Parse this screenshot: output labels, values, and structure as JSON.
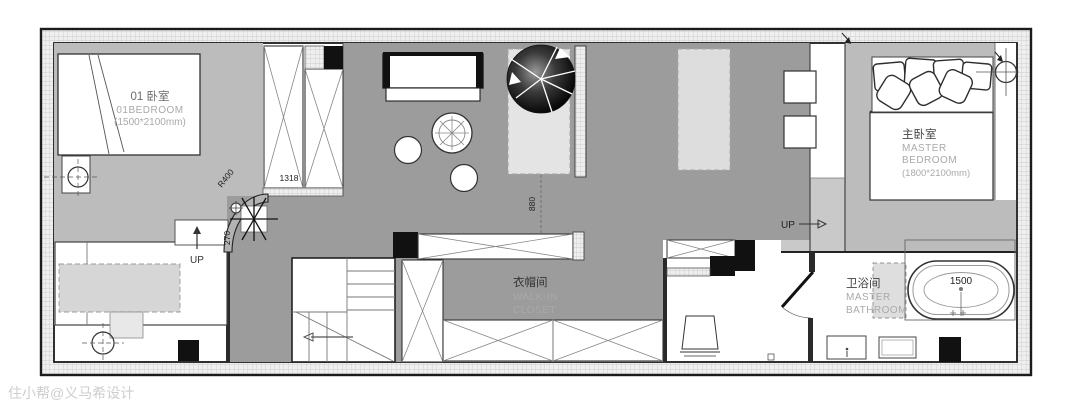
{
  "plan": {
    "watermark": "住小帮@义马希设计",
    "bedroom01": {
      "name_zh": "01 卧室",
      "name_en": "01BEDROOM",
      "size": "(1500*2100mm)"
    },
    "master_bedroom": {
      "name_zh": "主卧室",
      "en1": "MASTER",
      "en2": "BEDROOM",
      "size": "(1800*2100mm)"
    },
    "walk_in_closet": {
      "name_zh": "衣帽间",
      "en1": "WALK-IN",
      "en2": "CLOSET"
    },
    "master_bathroom": {
      "name_zh": "卫浴间",
      "en1": "MASTER",
      "en2": "BATHROOM"
    },
    "dims": {
      "wardrobe_width": "1318",
      "closet_gap": "880",
      "curve_radius": "R400",
      "curve_rise": "270",
      "bathtub_length": "1500"
    },
    "nav": {
      "up_left": "UP",
      "up_right": "UP"
    }
  }
}
